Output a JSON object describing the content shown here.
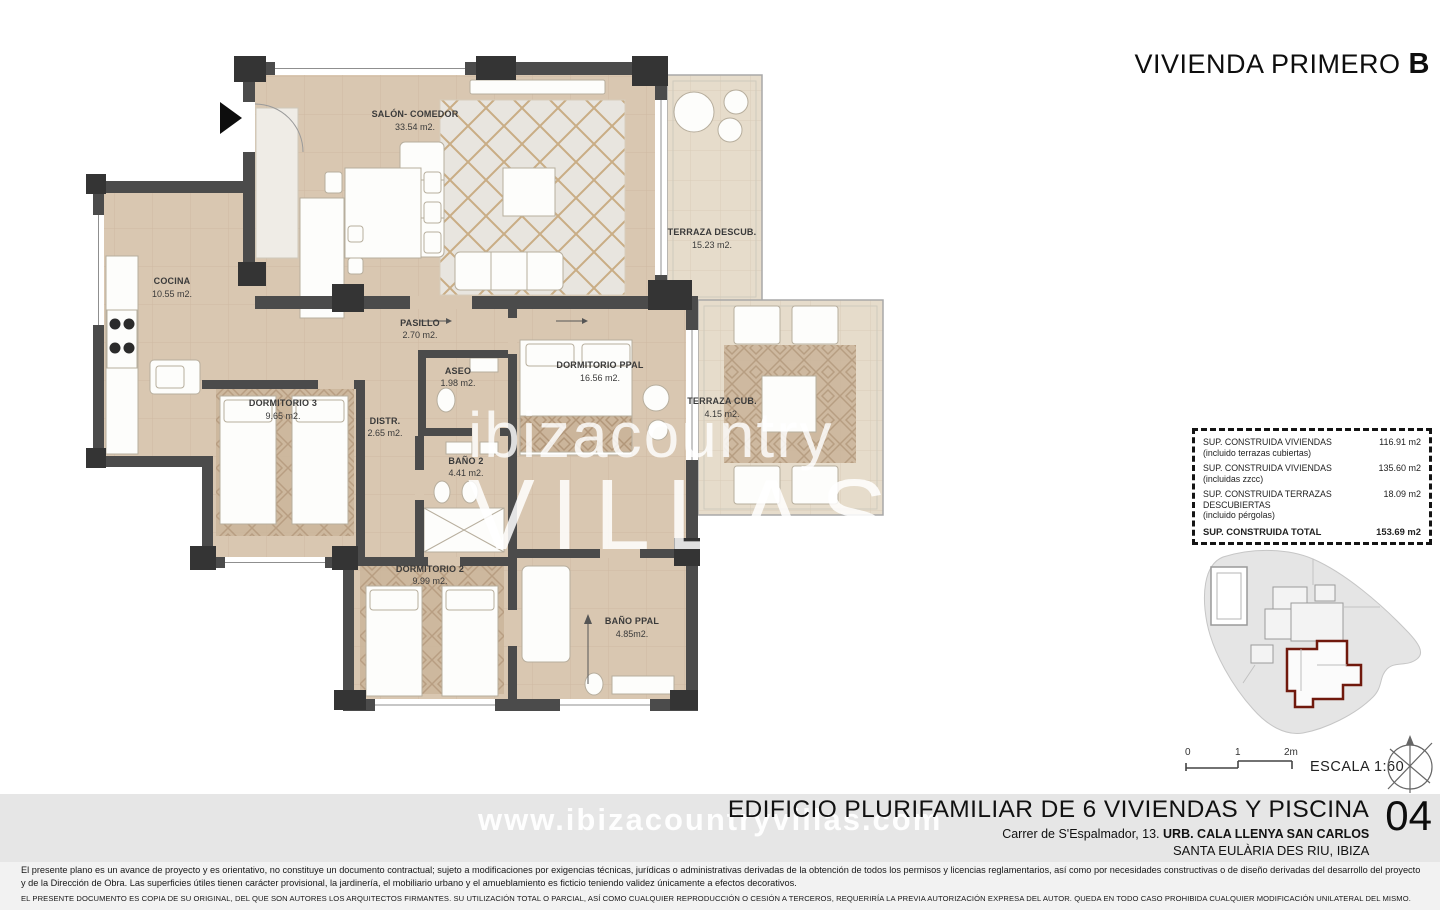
{
  "header": {
    "title_regular": "VIVIENDA PRIMERO",
    "title_bold": "B"
  },
  "plan": {
    "rooms": [
      {
        "name": "SALÓN- COMEDOR",
        "area": "33.54 m2."
      },
      {
        "name": "COCINA",
        "area": "10.55 m2."
      },
      {
        "name": "TERRAZA DESCUB.",
        "area": "15.23 m2."
      },
      {
        "name": "PASILLO",
        "area": "2.70 m2."
      },
      {
        "name": "ASEO",
        "area": "1.98 m2."
      },
      {
        "name": "DORMITORIO PPAL",
        "area": "16.56 m2."
      },
      {
        "name": "DORMITORIO 3",
        "area": "9.65 m2."
      },
      {
        "name": "DISTR.",
        "area": "2.65 m2."
      },
      {
        "name": "BAÑO 2",
        "area": "4.41 m2."
      },
      {
        "name": "TERRAZA CUB.",
        "area": "4.15 m2."
      },
      {
        "name": "DORMITORIO 2",
        "area": "9.99 m2."
      },
      {
        "name": "BAÑO PPAL",
        "area": "4.85m2."
      }
    ]
  },
  "summary_table": {
    "rows": [
      {
        "label": "SUP. CONSTRUIDA VIVIENDAS",
        "sublabel": "(incluido terrazas cubiertas)",
        "value": "116.91 m2"
      },
      {
        "label": "SUP. CONSTRUIDA VIVIENDAS",
        "sublabel": "(incluidas zzcc)",
        "value": "135.60 m2"
      },
      {
        "label": "SUP. CONSTRUIDA TERRAZAS DESCUBIERTAS",
        "sublabel": "(incluido pérgolas)",
        "value": "18.09 m2"
      },
      {
        "label": "SUP. CONSTRUIDA TOTAL",
        "sublabel": "",
        "value": "153.69 m2"
      }
    ]
  },
  "scale": {
    "ticks": [
      "0",
      "1",
      "2m"
    ],
    "label": "ESCALA 1:60"
  },
  "title_block": {
    "project": "EDIFICIO PLURIFAMILIAR DE 6 VIVIENDAS Y PISCINA",
    "sheet_number": "04",
    "address_regular": "Carrer de S'Espalmador, 13. ",
    "address_bold": "URB. CALA LLENYA SAN CARLOS",
    "city": "SANTA EULÀRIA DES RIU, IBIZA"
  },
  "watermark": {
    "plan_line1": "ibizacountry",
    "plan_line2": "VILLAS",
    "footer": "www.ibizacountryvillas.com"
  },
  "disclaimer": {
    "paragraph": "El presente plano es un avance de proyecto y es orientativo, no constituye un documento contractual; sujeto a modificaciones por exigencias técnicas, jurídicas o administrativas derivadas de la obtención de todos los permisos y licencias reglamentarios, así como por necesidades constructivas o de diseño derivadas del desarrollo del proyecto y de la Dirección de Obra. Las superficies útiles tienen carácter provisional, la jardinería, el mobiliario urbano y el amueblamiento es ficticio teniendo validez únicamente a efectos decorativos.",
    "legal": "EL PRESENTE DOCUMENTO ES COPIA DE SU ORIGINAL, DEL QUE SON AUTORES LOS ARQUITECTOS FIRMANTES. SU UTILIZACIÓN TOTAL O PARCIAL, ASÍ COMO CUALQUIER REPRODUCCIÓN O CESIÓN A TERCEROS, REQUERIRÍA LA PREVIA AUTORIZACIÓN EXPRESA DEL AUTOR. QUEDA EN TODO CASO PROHIBIDA CUALQUIER MODIFICACIÓN UNILATERAL DEL MISMO."
  },
  "colors": {
    "wall": "#4b4b4b",
    "floor_tile": "#d9c7b1",
    "terrace_tile": "#e6dccb",
    "rug": "#cbb59b",
    "accent_red": "#70190d",
    "band_gray": "#e6e6e6"
  }
}
